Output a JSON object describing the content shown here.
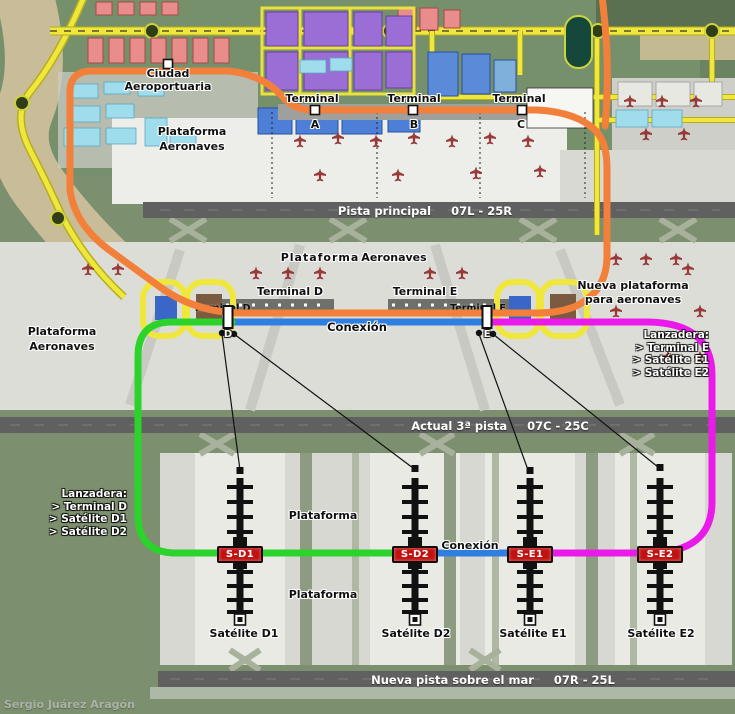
{
  "city": {
    "line1": "Ciudad",
    "line2": "Aeroportuaria"
  },
  "apron_abc": {
    "line1": "Plataforma",
    "line2": "Aeronaves"
  },
  "terminals_abc": [
    {
      "label": "Terminal",
      "letter": "A"
    },
    {
      "label": "Terminal",
      "letter": "B"
    },
    {
      "label": "Terminal",
      "letter": "C"
    }
  ],
  "runways": [
    {
      "name": "Pista principal",
      "designation": "07L - 25R"
    },
    {
      "name": "Actual 3ª pista",
      "designation": "07C - 25C"
    },
    {
      "name": "Nueva pista sobre el mar",
      "designation": "07R - 25L"
    }
  ],
  "mid": {
    "plataforma": "Plataforma",
    "aeronaves": "Aeronaves",
    "terminal_d": "Terminal D",
    "terminal_e": "Terminal E",
    "nueva_plataforma_1": "Nueva plataforma",
    "nueva_plataforma_2": "para aeronaves",
    "apron_left_1": "Plataforma",
    "apron_left_2": "Aeronaves",
    "station_d_label": "Terminal D",
    "station_e_label": "Terminal E",
    "station_d_letter": "D",
    "station_e_letter": "E",
    "conexion": "Conexión"
  },
  "lanzadera_right": {
    "title": "Lanzadera:",
    "item1": "> Terminal E",
    "item2": "> Satélite E1",
    "item3": "> Satélite E2"
  },
  "lanzadera_left": {
    "title": "Lanzadera:",
    "item1": "> Terminal D",
    "item2": "> Satélite D1",
    "item3": "> Satélite D2"
  },
  "satellite_area": {
    "plataforma_top": "Plataforma",
    "plataforma_bottom": "Plataforma",
    "conexion": "Conexión"
  },
  "satellites": [
    {
      "badge": "S-D1",
      "label": "Satélite D1"
    },
    {
      "badge": "S-D2",
      "label": "Satélite D2"
    },
    {
      "badge": "S-E1",
      "label": "Satélite E1"
    },
    {
      "badge": "S-E2",
      "label": "Satélite E2"
    }
  ],
  "credit": "Sergio Juárez Aragón",
  "colors": {
    "route_orange": "#F2803A",
    "route_green": "#2BD32B",
    "route_magenta": "#EA1BEA",
    "route_blue": "#2E7FE0",
    "road_yellow": "#EFE73C",
    "badge_red": "#C11212",
    "runway_gray": "#606060"
  }
}
